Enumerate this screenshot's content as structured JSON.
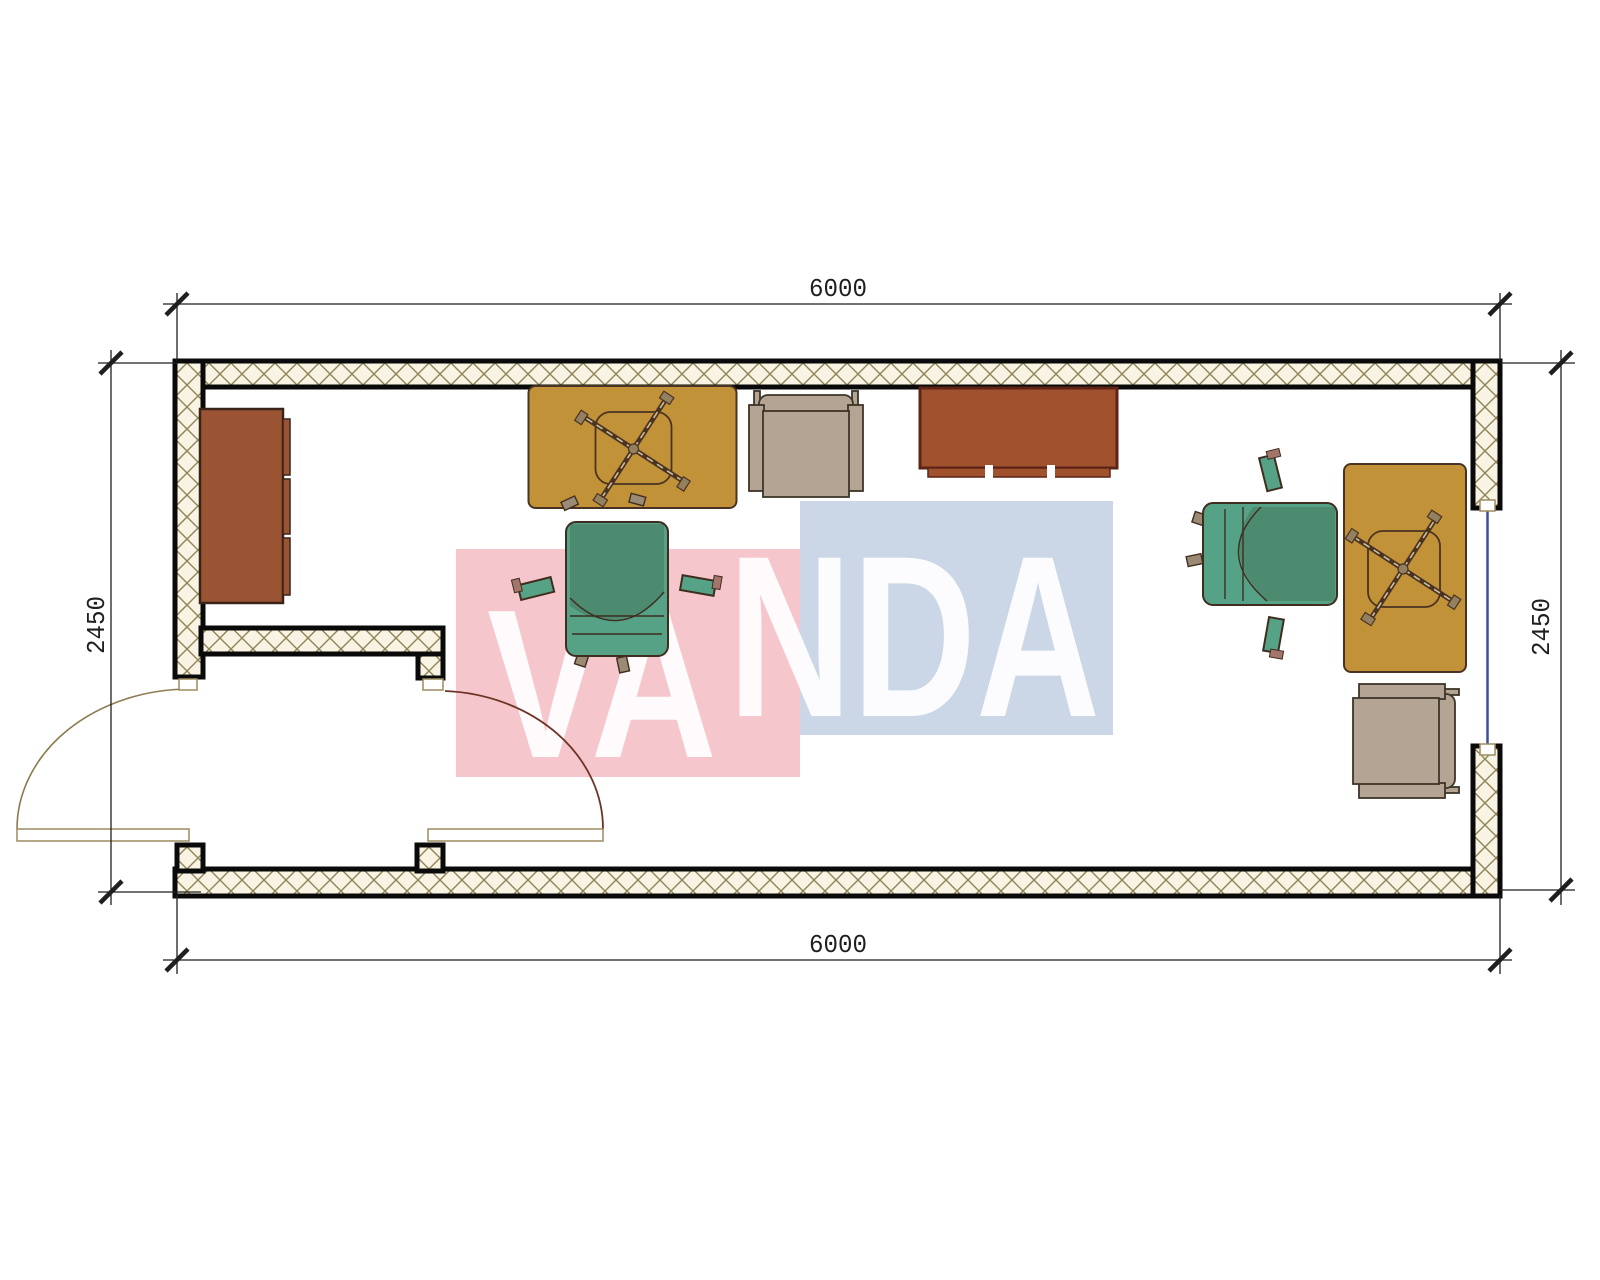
{
  "drawing": {
    "type": "floor-plan",
    "description": "Top view plan of a 6000 x 2450 container office with entry vestibule, two desks with swivel chairs, two armchairs, drawer cabinet and sideboard"
  },
  "dimensions": {
    "top": "6000",
    "bottom": "6000",
    "left": "2450",
    "right": "2450"
  },
  "watermark": {
    "text": "VANDA",
    "left_part": "VA",
    "right_part": "NDA",
    "pink": "#F5C7CC",
    "blue": "#CBD7E6",
    "text_color": "#FFFFFF"
  },
  "colors": {
    "wm-pink": "#F5C7CC",
    "wm-blue": "#CBD7E6",
    "wall-fill": "#F8F3E2",
    "hatch-line": "#8F8458",
    "wall-edge": "#0A0A0A",
    "desk-yellow": "#C29238",
    "desk-line": "#4A3322",
    "chair-green": "#56A287",
    "chair-line": "#3F2D1F",
    "chair-shade": "rgba(40,40,10,0.18)",
    "armchair-grey": "#B3A494",
    "armchair-line": "#3E3428",
    "cabinet-brown": "#9B5433",
    "cabinet-line": "#3A241A",
    "sideboard-brown": "#A0512E",
    "sideboard-line": "#5C2415",
    "door-frame": "#9B8C5E",
    "door-arc-exterior": "#8C7B50",
    "door-arc-interior": "#6E3526",
    "window-blue": "#3F4E9C",
    "dim-color": "#1F1F1F",
    "watermark-text": "rgba(255,255,255,0.93)"
  }
}
